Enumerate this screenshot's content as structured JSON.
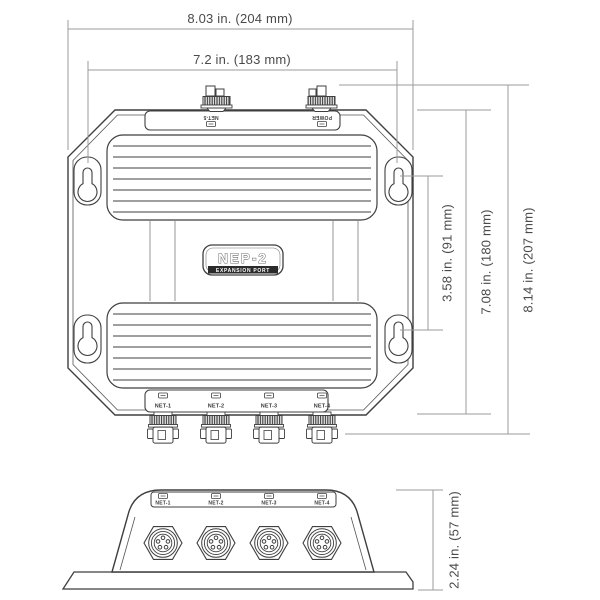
{
  "drawing": {
    "model": "NEP-2",
    "model_subtitle": "EXPANSION PORT",
    "top_ports": {
      "net5": "NET-5",
      "power": "POWER"
    },
    "network_ports": [
      "NET-1",
      "NET-2",
      "NET-3",
      "NET-4"
    ],
    "dimensions": {
      "overall_width": "8.03 in. (204 mm)",
      "mounting_width": "7.2 in. (183 mm)",
      "mounting_hole_spacing": "3.58 in. (91 mm)",
      "body_height": "7.08 in. (180 mm)",
      "overall_height": "8.14 in. (207 mm)",
      "depth": "2.24 in. (57 mm)"
    },
    "colors": {
      "outline": "#3f3f3f",
      "dimension_line": "#9b9b9b",
      "text": "#4a4a4a",
      "fill": "#ffffff",
      "dark_fill": "#2b2b2b"
    }
  }
}
